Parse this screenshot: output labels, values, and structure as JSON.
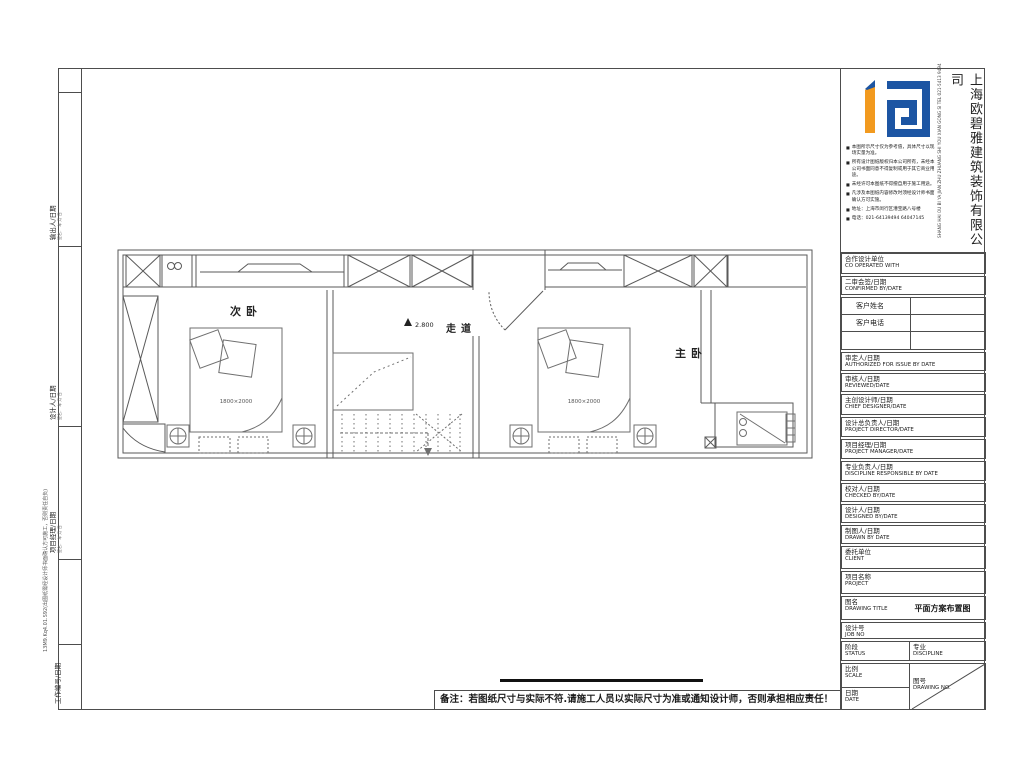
{
  "colors": {
    "wall": "#4d4d4d",
    "furniture": "#6f6f6f",
    "logo_blue": "#1c55a3",
    "logo_orange": "#f29a1f"
  },
  "left_strip": {
    "sections": [
      {
        "label": "输出人/日期",
        "sub": "签名： 年 月 日"
      },
      {
        "label": "设计人/日期",
        "sub": "签名： 年 月 日"
      },
      {
        "label": "项目经理/日期",
        "sub": "签名： 年 月 日"
      },
      {
        "label": "工作编号/日期",
        "sub": ""
      }
    ],
    "stamp": "13M9.Kq4.01.S92(出图纸需经设计师书面确认方可施工，否则责任自负)"
  },
  "plan": {
    "room_labels": {
      "secondary_bedroom": "次卧",
      "corridor": "走道",
      "master_bedroom": "主卧"
    },
    "elevation_label": "2.800",
    "bed_size_label": "1800×2000"
  },
  "note": "备注：若图纸尺寸与实际不符.请施工人员以实际尺寸为准或通知设计师，否则承担相应责任！",
  "titleblock": {
    "company_name": "上海欧碧雅建筑装饰有限公司",
    "company_side_text": "SHANG HAI OU BI YA JIAN ZHU ZHUANG SHI YOU XIAN GONG SI TEL 021-5413 9494",
    "notices": [
      "本图所示尺寸仅为参考值，具体尺寸以现场实量为准。",
      "所有设计图纸版权归本公司所有，未经本公司书面同意不得复制或用于其它商业用途。",
      "未经许可本图纸不得擅自用于施工用途。",
      "凡涉及本图纸内容修改时须经设计师书面确认方可实施。",
      "地址：上海市闵行区漕宝路八号楼",
      "电话：021-64139494 64047145"
    ],
    "fields": {
      "co_op": {
        "cn": "合作设计单位",
        "en": "CO OPERATED WITH"
      },
      "confirmed": {
        "cn": "二审会签/日期",
        "en": "CONFIRMED BY/DATE"
      },
      "client_name": {
        "cn": "客户姓名"
      },
      "client_phone": {
        "cn": "客户电话"
      },
      "authorized": {
        "cn": "审定人/日期",
        "en": "AUTHORIZED FOR ISSUE BY DATE"
      },
      "reviewed": {
        "cn": "审核人/日期",
        "en": "REVIEWED/DATE"
      },
      "chief": {
        "cn": "主创设计师/日期",
        "en": "CHIEF DESIGNER/DATE"
      },
      "director": {
        "cn": "设计总负责人/日期",
        "en": "PROJECT DIRECTOR/DATE"
      },
      "manager": {
        "cn": "项目经理/日期",
        "en": "PROJECT MANAGER/DATE"
      },
      "discipline_resp": {
        "cn": "专业负责人/日期",
        "en": "DISCIPLINE RESPONSIBLE BY DATE"
      },
      "checked": {
        "cn": "校对人/日期",
        "en": "CHECKED BY/DATE"
      },
      "designed": {
        "cn": "设计人/日期",
        "en": "DESIGNED BY/DATE"
      },
      "drawn": {
        "cn": "制图人/日期",
        "en": "DRAWN BY DATE"
      },
      "client": {
        "cn": "委托单位",
        "en": "CLIENT"
      },
      "project": {
        "cn": "项目名称",
        "en": "PROJECT"
      },
      "drawing_title": {
        "cn": "图名",
        "en": "DRAWING TITLE"
      },
      "job_no": {
        "cn": "设计号",
        "en": "JOB NO"
      },
      "status": {
        "cn": "阶段",
        "en": "STATUS"
      },
      "discipline": {
        "cn": "专业",
        "en": "DISCIPLINE"
      },
      "scale": {
        "cn": "比例",
        "en": "SCALE"
      },
      "drawing_no": {
        "cn": "图号",
        "en": "DRAWING NO."
      },
      "date": {
        "cn": "日期",
        "en": "DATE"
      }
    },
    "drawing_title_value": "平面方案布置图"
  }
}
